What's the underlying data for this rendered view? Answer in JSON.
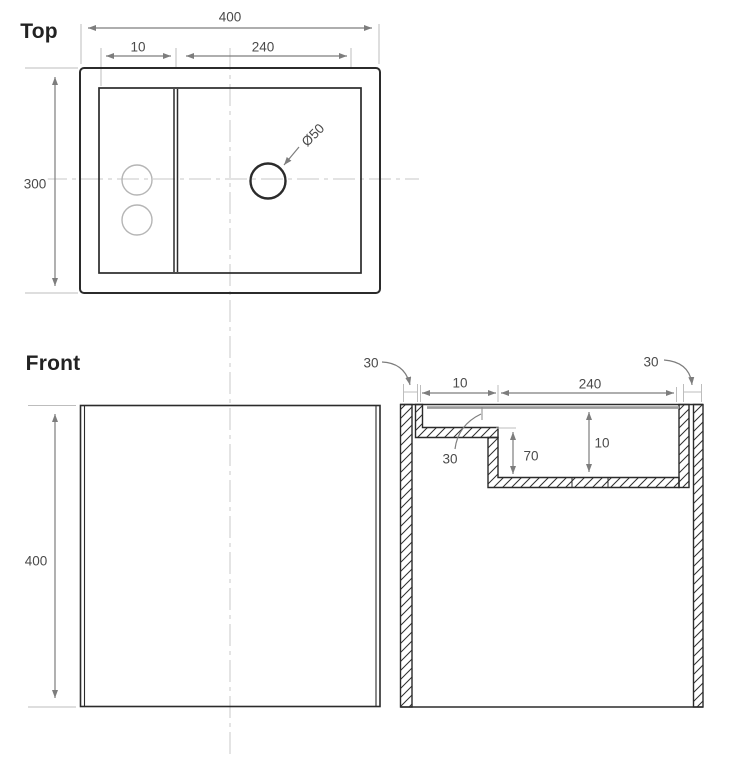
{
  "colors": {
    "object_line": "#2b2b2b",
    "dimension_line": "#7d7d7d",
    "extension_line": "#bdbdbd",
    "centerline": "#d2d2d2",
    "faint_circle": "#b5b5b5",
    "lid_edge": "#9c9c9c",
    "label_text": "#4a4a4a",
    "title_text": "#222222"
  },
  "titles": {
    "top": "Top",
    "front": "Front"
  },
  "top_view": {
    "overall_width": "400",
    "tray_offset": "10",
    "basin_width": "240",
    "overall_depth": "300",
    "drain_diameter": "Ø50"
  },
  "front_view": {
    "overall_height": "400"
  },
  "section_view": {
    "left_wall_thickness": "30",
    "right_wall_thickness": "30",
    "ledge_width": "10",
    "basin_width": "240",
    "ledge_wall_thickness": "30",
    "step_depth": "70",
    "basin_depth": "10"
  }
}
